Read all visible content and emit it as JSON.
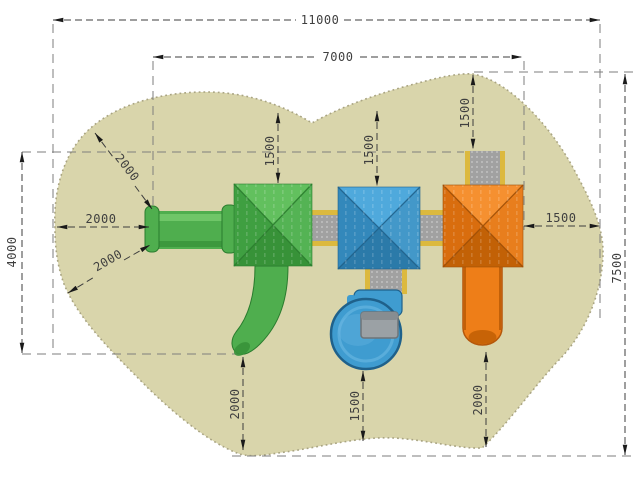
{
  "drawing": {
    "view": "playground-structure-top-view-plan",
    "dimensions": {
      "total_width": "11000",
      "inner_width": "7000",
      "left_height": "4000",
      "total_height": "7500",
      "top_clearance_green": "1500",
      "top_clearance_blue": "1500",
      "top_clearance_orange": "1500",
      "right_clearance": "1500",
      "bottom_clearance_green": "2000",
      "bottom_clearance_blue": "1500",
      "bottom_clearance_orange": "2000",
      "left_clearance_mid": "2000",
      "left_clearance_upper": "2000",
      "left_clearance_lower": "2000"
    }
  },
  "colors": {
    "background": "#ffffff",
    "safety_area": "#d9d5ab",
    "safety_area_edge": "#a9a482",
    "dimension_line": "#3d3d3d",
    "guide_line": "#7e7e7e",
    "arrow": "#1a1a1a",
    "label_text": "#3f3f3f",
    "yellow_trim": "#dcb93e",
    "walkway_gray": "#a1a1a1",
    "walkway_dot": "#c9c9c9",
    "step_gray": "#9ba1a5",
    "green": {
      "main": "#4fae4e",
      "light": "#74ca6d",
      "dark": "#37923a",
      "roof_top": "#62c05e",
      "roof_left": "#3f9f41",
      "roof_right": "#54b354",
      "roof_bottom": "#379238",
      "ridge": "#2a7c2e"
    },
    "blue": {
      "main": "#3f9cd0",
      "light": "#6fbbe4",
      "dark": "#2b7aa9",
      "roof_top": "#4fa9dc",
      "roof_left": "#3388bb",
      "roof_right": "#4398c9",
      "roof_bottom": "#2b7aa9",
      "ridge": "#1f618b"
    },
    "orange": {
      "main": "#ee7e18",
      "light": "#f9a04a",
      "dark": "#c26106",
      "roof_top": "#f59030",
      "roof_left": "#d96d0e",
      "roof_right": "#e87e1d",
      "roof_bottom": "#c26106",
      "ridge": "#9d4e05"
    }
  }
}
